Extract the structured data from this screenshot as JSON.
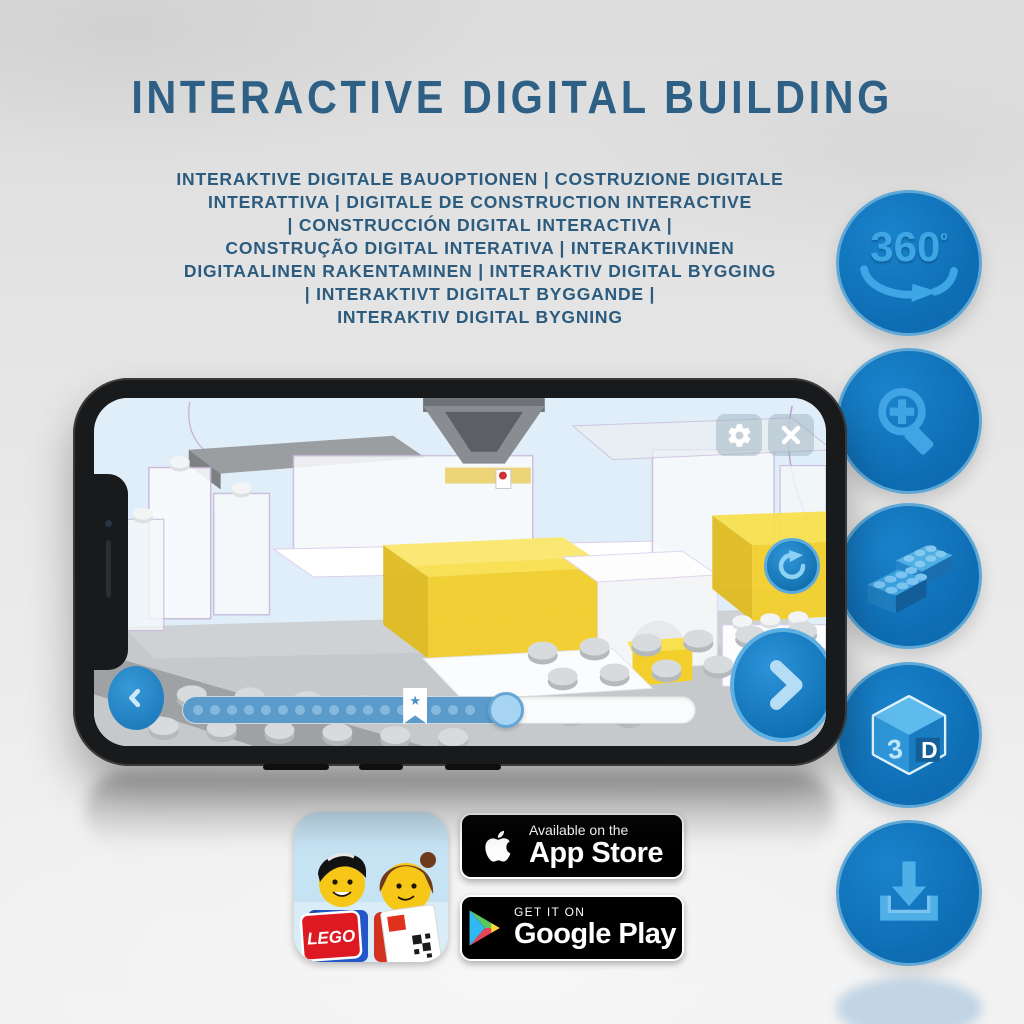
{
  "header": {
    "title": "INTERACTIVE DIGITAL BUILDING",
    "subtitle_lines": [
      "INTERAKTIVE DIGITALE BAUOPTIONEN | COSTRUZIONE DIGITALE",
      "INTERATTIVA | DIGITALE DE CONSTRUCTION INTERACTIVE",
      "| CONSTRUCCIÓN DIGITAL INTERACTIVA |",
      "CONSTRUÇÃO DIGITAL INTERATIVA | INTERAKTIIVINEN",
      "DIGITAALINEN RAKENTAMINEN | INTERAKTIV DIGITAL BYGGING",
      "| INTERAKTIVT DIGITALT BYGGANDE |",
      "INTERAKTIV DIGITAL BYGNING"
    ]
  },
  "feature_badges": {
    "rotation_label": "360",
    "rotation_degree": "º",
    "cube_left": "3",
    "cube_right": "D",
    "icons": [
      "360-rotation-icon",
      "zoom-in-icon",
      "brick-building-icon",
      "3d-cube-icon",
      "download-icon"
    ]
  },
  "phone_ui": {
    "progress_percent": 63,
    "bookmark_percent": 43,
    "star_glyph": "★"
  },
  "store_badges": {
    "app_icon_logo": "LEGO",
    "app_store": {
      "tagline": "Available on the",
      "name": "App Store"
    },
    "google_play": {
      "tagline": "GET IT ON",
      "name": "Google Play"
    }
  },
  "colors": {
    "headline_blue": "#2d6084",
    "feature_circle_blue": "#0e6fb5",
    "feature_icon_blue": "#41a5e5",
    "app_accent_blue": "#2388cf",
    "highlight_yellow": "#f3cf2c",
    "badge_black": "#000000"
  }
}
